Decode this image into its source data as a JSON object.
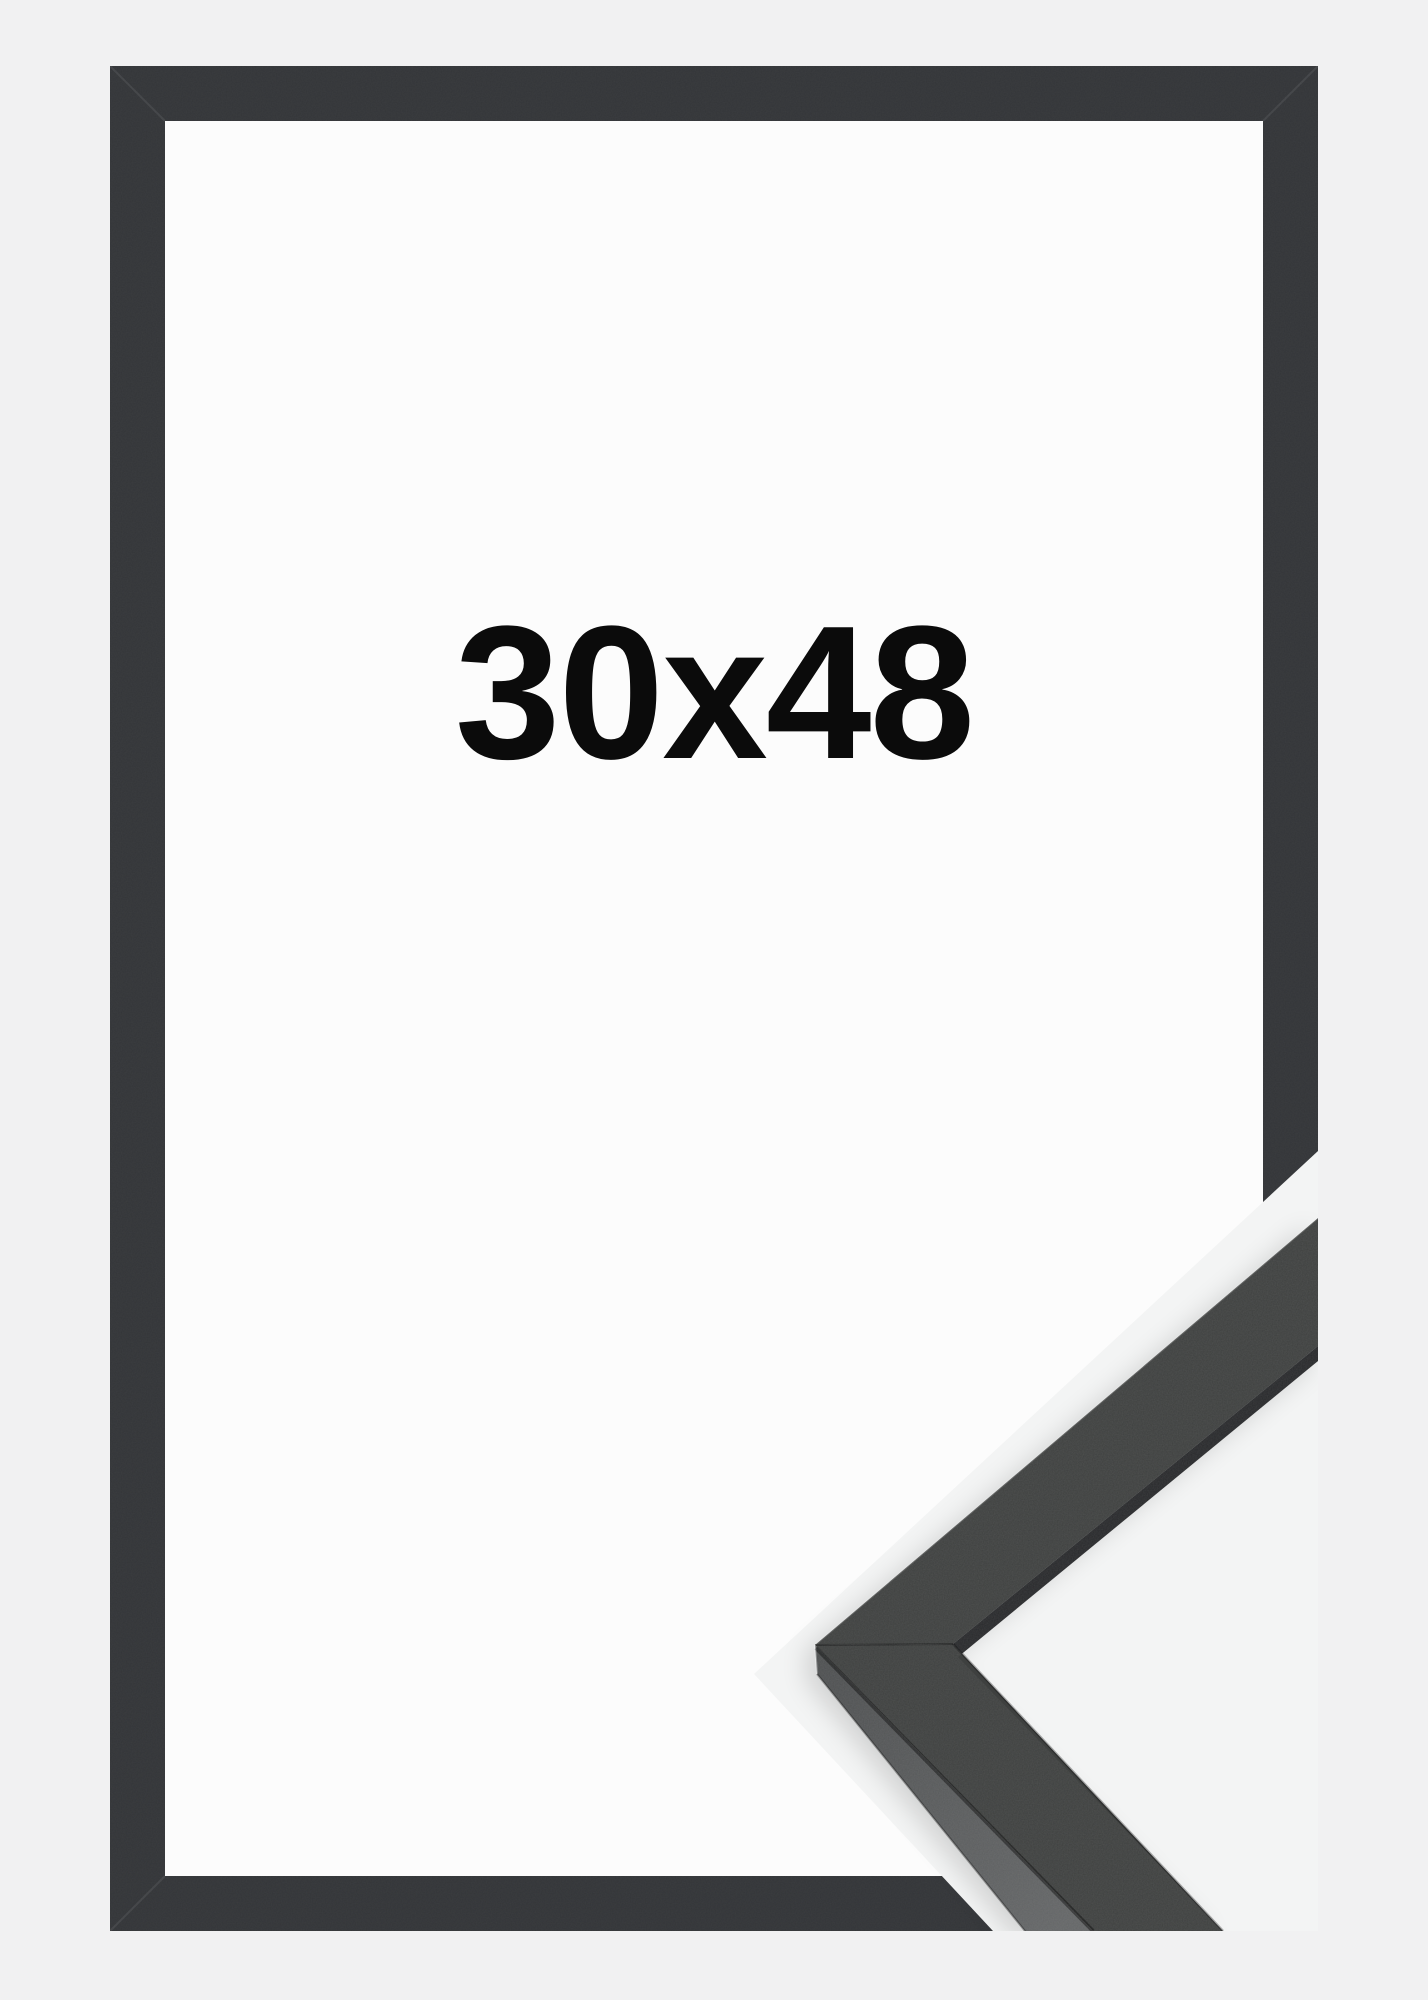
{
  "product": {
    "size_label": "30x48"
  },
  "image_parts": {
    "frame_front_view": "flat black frame, front view",
    "corner_sample": "photographed mitered corner profile of the black molding, bottom-right"
  },
  "colors": {
    "page_bg": "#f1f1f2",
    "frame_opening_bg": "#fcfcfc",
    "frame_bar": "#333538",
    "photo_bg": "#f3f4f4",
    "molding_top": "#3e403f",
    "molding_inner_shadow": "#28292b",
    "molding_side_light": "#5a5c5d",
    "label_text": "#0b0b0b"
  }
}
